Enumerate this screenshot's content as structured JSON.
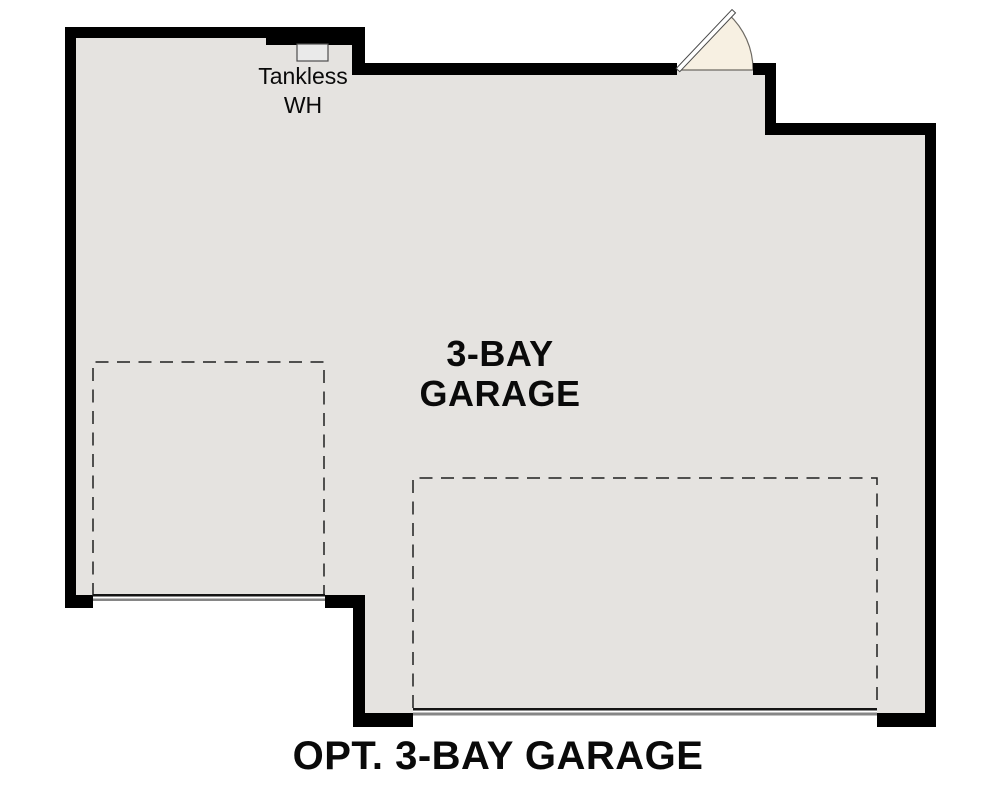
{
  "plan": {
    "caption": "OPT. 3-BAY GARAGE",
    "room": {
      "name_line1": "3-BAY",
      "name_line2": "GARAGE"
    },
    "annotations": {
      "tankless_line1": "Tankless",
      "tankless_line2": "WH"
    }
  },
  "colors": {
    "background": "#ffffff",
    "floor": "#e5e3e0",
    "wall": "#000000",
    "text": "#0a0a0a",
    "bay_outline": "#1f1f1f",
    "door_line": "#151515",
    "door_line_shadow": "#868686",
    "door_swing_fill": "#f7f0e2",
    "door_swing_stroke": "#6e6a63",
    "door_leaf_fill": "#ffffff",
    "door_leaf_stroke": "#4a4a4a",
    "tankless_fill": "#eaeaea",
    "tankless_stroke": "#4d4d4d"
  }
}
